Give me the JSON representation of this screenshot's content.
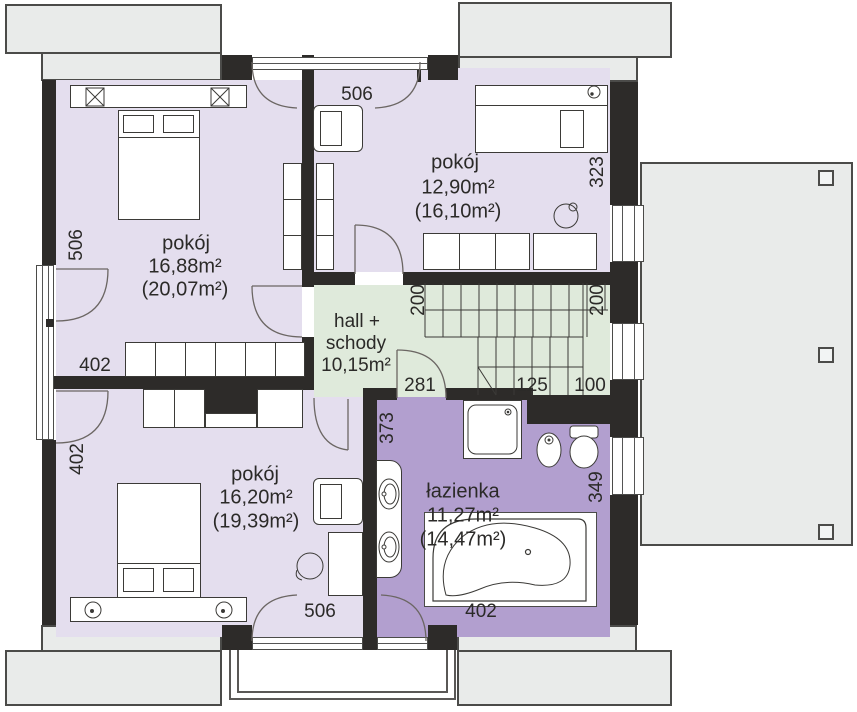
{
  "palette": {
    "wall": "#2d2b29",
    "room_purple": "#e4deee",
    "hall_green": "#dfeadb",
    "bath_purple": "#b29fcf",
    "roof_gray": "#e9ebea",
    "line": "#3b3a37"
  },
  "rooms": {
    "top_left": {
      "name": "pokój",
      "area": "16,88m²",
      "area_total": "(20,07m²)"
    },
    "top_right": {
      "name": "pokój",
      "area": "12,90m²",
      "area_total": "(16,10m²)"
    },
    "hall": {
      "name_line1": "hall +",
      "name_line2": "schody",
      "area": "10,15m²"
    },
    "bottom_left": {
      "name": "pokój",
      "area": "16,20m²",
      "area_total": "(19,39m²)"
    },
    "bathroom": {
      "name": "łazienka",
      "area": "11,27m²",
      "area_total": "(14,47m²)"
    }
  },
  "dimensions": {
    "top_width": "506",
    "left_upper_height": "506",
    "left_room_width": "402",
    "left_lower_height": "402",
    "right_upper_height": "323",
    "stairs_left": "200",
    "stairs_right": "200",
    "hall_width_left": "281",
    "hall_width_mid": "125",
    "hall_width_right": "100",
    "bath_left_height": "373",
    "bath_right_height": "349",
    "bottom_left_width": "506",
    "bottom_bath_width": "402"
  }
}
